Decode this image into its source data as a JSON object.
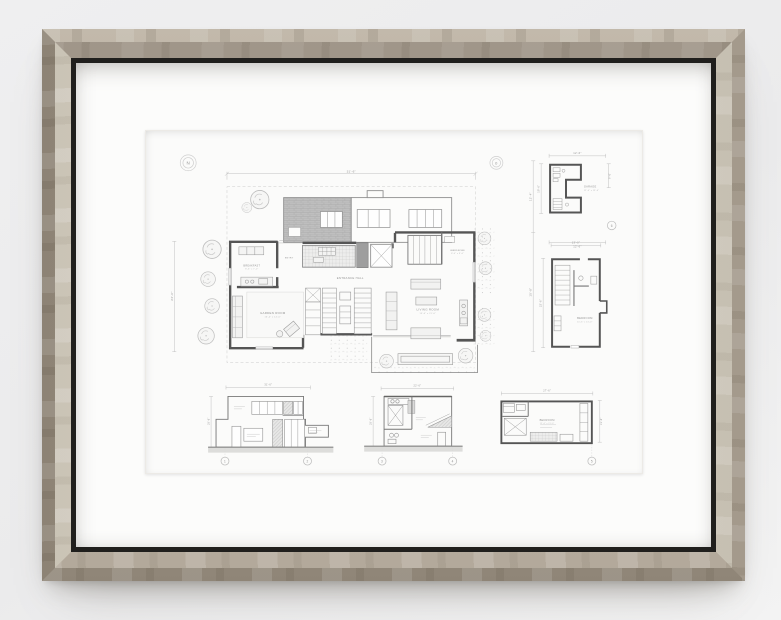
{
  "scene": {
    "wall_color": "#ededee"
  },
  "frame": {
    "wood": "#a89e90",
    "bevel": "#d5cec1",
    "lip": "#201f1d",
    "mat": "#fcfcfb",
    "paper": "#fbfbfa"
  },
  "sheet": {
    "markers": {
      "left": "N",
      "right": "0"
    },
    "main_plan": {
      "dim_top": "31'-6\"",
      "dim_left": "24'-0\"",
      "dim_right_upper": "12'-4\"",
      "dim_right_lower": "15'-8\"",
      "rooms": {
        "breakfast": {
          "label": "BREAKFAST",
          "size": "8'-6\" x 7'-0\""
        },
        "entry": {
          "label": "ENTRY"
        },
        "garden": {
          "label": "GARDEN ROOM",
          "size": "16'-4\" x 14'-0\""
        },
        "hall": {
          "label": "ENTRANCE HALL",
          "size": "9'-6\" x 15'-0\""
        },
        "living": {
          "label": "LIVING ROOM",
          "size": "15'-0\" x 21'-6\""
        },
        "wardrobe": {
          "label": "WARDROBE",
          "size": "8'-0\" x 9'-6\""
        }
      }
    },
    "garage_plan": {
      "label": "GARAGE",
      "size": "12'-0\" x 19'-6\"",
      "dim_top": "12'-6\"",
      "dim_left": "19'-0\"",
      "dim_right": "9'-6\"",
      "dim_bottom": "12'-6\"",
      "bubble": "6"
    },
    "bedroom_plan": {
      "label": "BEDROOM",
      "size": "10'-6\" x 13'-0\"",
      "dim_top": "13'-0\"",
      "dim_left": "22'-6\""
    },
    "elevations": [
      {
        "dim_top": "31'-6\"",
        "dim_left": "18'-6\"",
        "bubbles": [
          "1",
          "2"
        ]
      },
      {
        "dim_top": "22'-6\"",
        "dim_left": "18'-6\"",
        "bubbles": [
          "3",
          "4"
        ]
      },
      {
        "dim_top": "27'-6\"",
        "dim_right": "13'-6\"",
        "label": "BEDROOM",
        "size": "12'-6\" x 21'-0\"",
        "bubbles": [
          "5"
        ]
      }
    ]
  }
}
